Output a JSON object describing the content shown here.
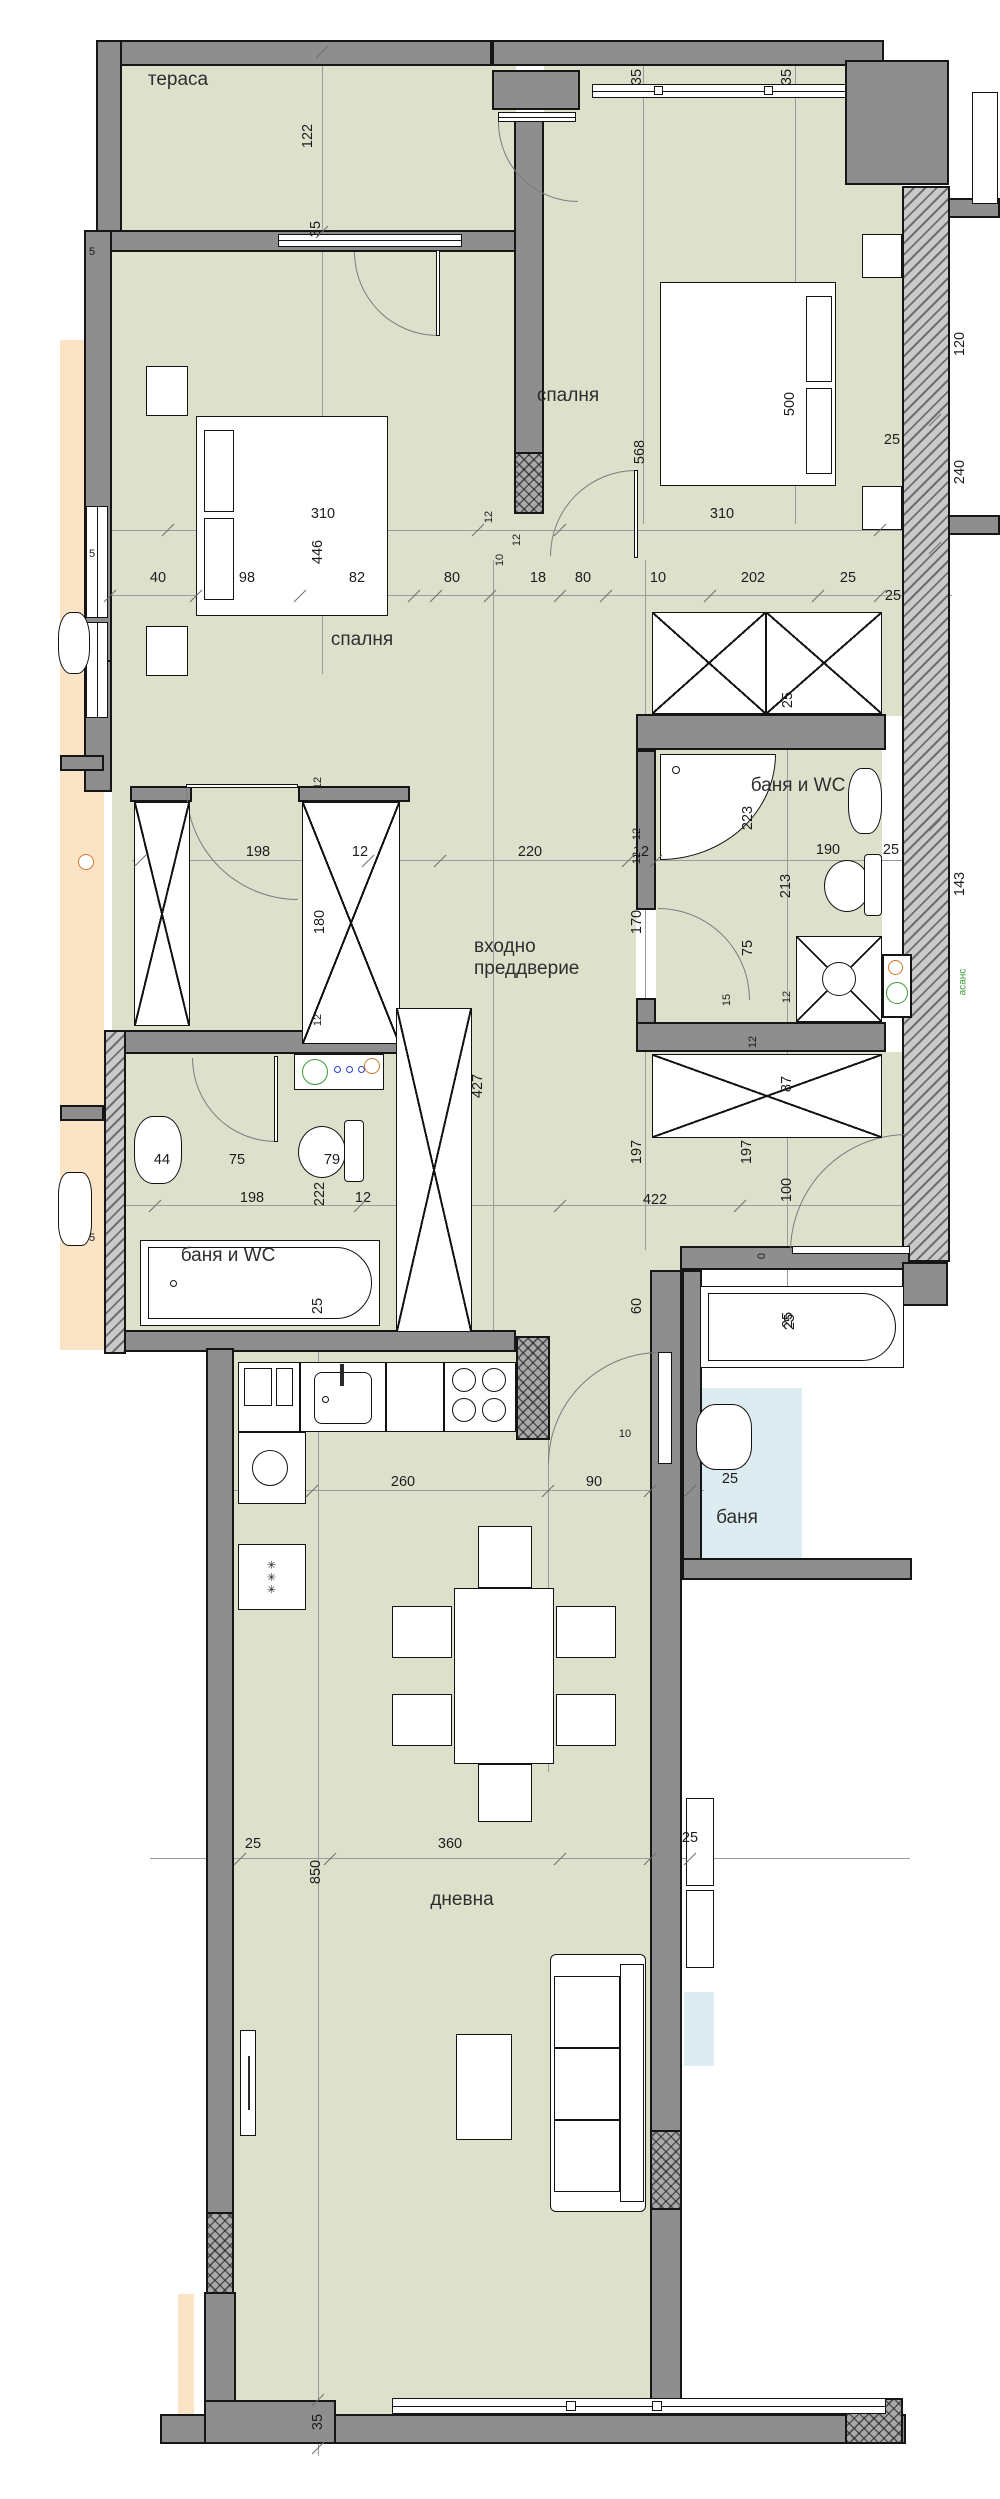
{
  "plan_title": "apartment floor plan",
  "room_labels": [
    {
      "name": "terrace",
      "text": "тераса",
      "x": 178,
      "y": 80
    },
    {
      "name": "bedroom-left",
      "text": "спалня",
      "x": 362,
      "y": 640
    },
    {
      "name": "bedroom-right",
      "text": "спалня",
      "x": 568,
      "y": 396
    },
    {
      "name": "entrance-hall",
      "text": "входно преддверие",
      "x": 540,
      "y": 958,
      "wrap": true
    },
    {
      "name": "bath-right",
      "text": "баня и WC",
      "x": 798,
      "y": 786
    },
    {
      "name": "bath-left",
      "text": "баня и WC",
      "x": 228,
      "y": 1256
    },
    {
      "name": "living-room",
      "text": "дневна",
      "x": 462,
      "y": 1900
    },
    {
      "name": "neighbor-bath",
      "text": "баня",
      "x": 737,
      "y": 1518
    }
  ],
  "dimension_labels": [
    {
      "text": "122",
      "x": 308,
      "y": 136,
      "v": true
    },
    {
      "text": "35",
      "x": 316,
      "y": 229,
      "v": true
    },
    {
      "text": "35",
      "x": 637,
      "y": 77,
      "v": true
    },
    {
      "text": "35",
      "x": 787,
      "y": 77,
      "v": true
    },
    {
      "text": "310",
      "x": 323,
      "y": 514
    },
    {
      "text": "446",
      "x": 318,
      "y": 552,
      "v": true
    },
    {
      "text": "40",
      "x": 158,
      "y": 578
    },
    {
      "text": "98",
      "x": 247,
      "y": 578
    },
    {
      "text": "82",
      "x": 357,
      "y": 578
    },
    {
      "text": "80",
      "x": 452,
      "y": 578
    },
    {
      "text": "12",
      "x": 489,
      "y": 517,
      "v": true,
      "s": true
    },
    {
      "text": "12",
      "x": 517,
      "y": 540,
      "v": true,
      "s": true
    },
    {
      "text": "10",
      "x": 500,
      "y": 560,
      "v": true,
      "s": true
    },
    {
      "text": "18",
      "x": 538,
      "y": 578
    },
    {
      "text": "80",
      "x": 583,
      "y": 578
    },
    {
      "text": "10",
      "x": 658,
      "y": 578
    },
    {
      "text": "202",
      "x": 753,
      "y": 578
    },
    {
      "text": "25",
      "x": 848,
      "y": 578
    },
    {
      "text": "500",
      "x": 790,
      "y": 404,
      "v": true
    },
    {
      "text": "568",
      "x": 640,
      "y": 452,
      "v": true
    },
    {
      "text": "310",
      "x": 722,
      "y": 514
    },
    {
      "text": "120",
      "x": 960,
      "y": 344,
      "v": true
    },
    {
      "text": "25",
      "x": 892,
      "y": 440
    },
    {
      "text": "240",
      "x": 960,
      "y": 472,
      "v": true
    },
    {
      "text": "25",
      "x": 893,
      "y": 596
    },
    {
      "text": "143",
      "x": 960,
      "y": 884,
      "v": true
    },
    {
      "text": "198",
      "x": 258,
      "y": 852
    },
    {
      "text": "12",
      "x": 360,
      "y": 852
    },
    {
      "text": "220",
      "x": 530,
      "y": 852
    },
    {
      "text": "12",
      "x": 641,
      "y": 852
    },
    {
      "text": "12",
      "x": 318,
      "y": 783,
      "v": true,
      "s": true
    },
    {
      "text": "180",
      "x": 320,
      "y": 922,
      "v": true
    },
    {
      "text": "12",
      "x": 318,
      "y": 1020,
      "v": true,
      "s": true
    },
    {
      "text": "170",
      "x": 637,
      "y": 922,
      "v": true
    },
    {
      "text": "427",
      "x": 478,
      "y": 1086,
      "v": true
    },
    {
      "text": "25",
      "x": 788,
      "y": 700,
      "v": true
    },
    {
      "text": "223",
      "x": 748,
      "y": 818,
      "v": true
    },
    {
      "text": "190",
      "x": 828,
      "y": 850
    },
    {
      "text": "25",
      "x": 891,
      "y": 850
    },
    {
      "text": "213",
      "x": 786,
      "y": 886,
      "v": true
    },
    {
      "text": "75",
      "x": 748,
      "y": 948,
      "v": true
    },
    {
      "text": "15",
      "x": 727,
      "y": 1000,
      "v": true,
      "s": true
    },
    {
      "text": "12",
      "x": 637,
      "y": 834,
      "v": true,
      "s": true
    },
    {
      "text": "12",
      "x": 637,
      "y": 858,
      "v": true,
      "s": true
    },
    {
      "text": "12",
      "x": 787,
      "y": 997,
      "v": true,
      "s": true
    },
    {
      "text": "12",
      "x": 753,
      "y": 1042,
      "v": true,
      "s": true
    },
    {
      "text": "87",
      "x": 787,
      "y": 1084,
      "v": true
    },
    {
      "text": "197",
      "x": 637,
      "y": 1152,
      "v": true
    },
    {
      "text": "197",
      "x": 747,
      "y": 1152,
      "v": true
    },
    {
      "text": "100",
      "x": 787,
      "y": 1190,
      "v": true
    },
    {
      "text": "422",
      "x": 655,
      "y": 1200
    },
    {
      "text": "0",
      "x": 762,
      "y": 1256,
      "v": true,
      "s": true
    },
    {
      "text": "60",
      "x": 637,
      "y": 1306,
      "v": true
    },
    {
      "text": "25",
      "x": 790,
      "y": 1322,
      "v": true
    },
    {
      "text": "44",
      "x": 162,
      "y": 1160
    },
    {
      "text": "75",
      "x": 237,
      "y": 1160
    },
    {
      "text": "79",
      "x": 332,
      "y": 1160
    },
    {
      "text": "198",
      "x": 252,
      "y": 1198
    },
    {
      "text": "222",
      "x": 320,
      "y": 1194,
      "v": true
    },
    {
      "text": "12",
      "x": 363,
      "y": 1198
    },
    {
      "text": "25",
      "x": 318,
      "y": 1306,
      "v": true
    },
    {
      "text": "260",
      "x": 403,
      "y": 1482
    },
    {
      "text": "90",
      "x": 594,
      "y": 1482
    },
    {
      "text": "10",
      "x": 625,
      "y": 1434,
      "s": true
    },
    {
      "text": "25",
      "x": 253,
      "y": 1844
    },
    {
      "text": "360",
      "x": 450,
      "y": 1844
    },
    {
      "text": "25",
      "x": 690,
      "y": 1838
    },
    {
      "text": "850",
      "x": 316,
      "y": 1872,
      "v": true
    },
    {
      "text": "35",
      "x": 318,
      "y": 2422,
      "v": true
    },
    {
      "text": "✳ ✳ ✳",
      "x": 272,
      "y": 1577,
      "v": true,
      "s": true
    },
    {
      "text": "25",
      "x": 788,
      "y": 1320,
      "v": true
    },
    {
      "text": "25",
      "x": 730,
      "y": 1479
    },
    {
      "text": "асанс",
      "x": 963,
      "y": 982,
      "v": true,
      "g": true
    },
    {
      "text": "5",
      "x": 92,
      "y": 252,
      "s": true
    },
    {
      "text": "5",
      "x": 92,
      "y": 554,
      "s": true
    },
    {
      "text": "5",
      "x": 92,
      "y": 1238,
      "s": true
    }
  ],
  "colors": {
    "floor": "#dde1cc",
    "wall": "#8e8e8e",
    "neighbor_left": "#fbe3c6",
    "neighbor_right_bath": "#dcecf0",
    "accent_green": "#3a9a35",
    "accent_orange": "#d07828",
    "accent_blue": "#2b3fd4"
  }
}
